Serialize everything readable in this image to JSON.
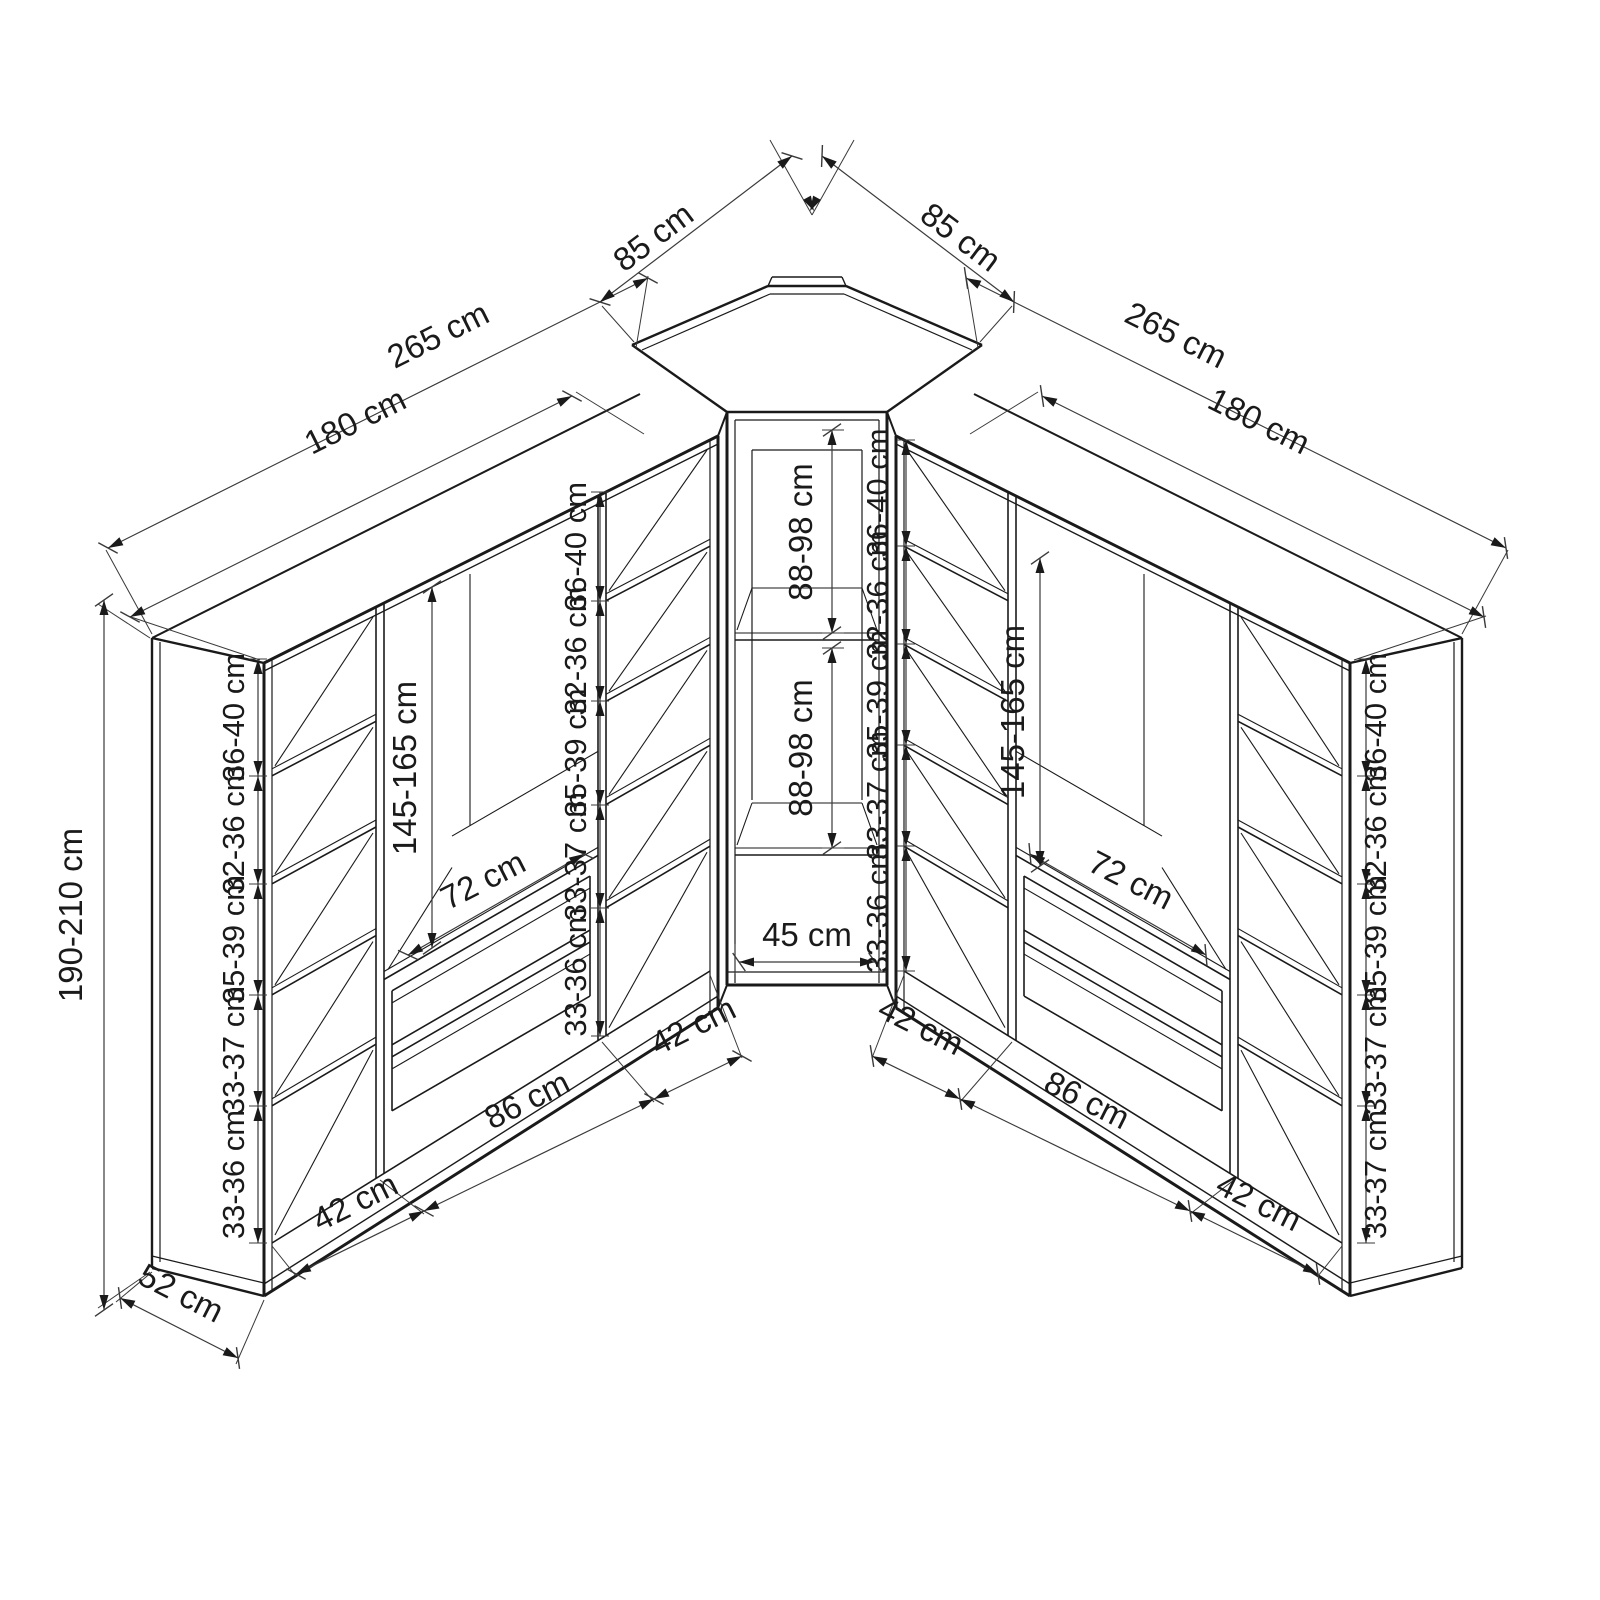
{
  "drawing": {
    "type": "corner-wardrobe-dimension-diagram",
    "unit": "cm"
  },
  "overall": {
    "height": "190-210 cm",
    "depth": "52 cm",
    "corner_front_left": "85 cm",
    "corner_front_right": "85 cm"
  },
  "left_wardrobe": {
    "total_width": "265 cm",
    "body_width": "180 cm",
    "outer_column": {
      "width": "42 cm",
      "shelf_spaces": [
        "36-40 cm",
        "32-36 cm",
        "35-39 cm",
        "33-37 cm",
        "33-36 cm"
      ]
    },
    "middle_section": {
      "hanging_height": "145-165 cm",
      "inner_width": "72 cm",
      "width": "86 cm"
    },
    "inner_column": {
      "width": "42 cm",
      "shelf_spaces": [
        "36-40 cm",
        "32-36 cm",
        "35-39 cm",
        "33-37 cm",
        "33-36 cm"
      ]
    }
  },
  "corner_unit": {
    "front_width": "45 cm",
    "upper_section_height": "88-98 cm",
    "lower_section_height": "88-98 cm"
  },
  "right_wardrobe": {
    "total_width": "265 cm",
    "body_width": "180 cm",
    "inner_column": {
      "width": "42 cm",
      "shelf_spaces": [
        "36-40 cm",
        "32-36 cm",
        "35-39 cm",
        "33-37 cm",
        "33-36 cm"
      ]
    },
    "middle_section": {
      "hanging_height": "145-165 cm",
      "inner_width": "72 cm",
      "width": "86 cm"
    },
    "outer_column": {
      "width": "42 cm",
      "shelf_spaces": [
        "36-40 cm",
        "32-36 cm",
        "35-39 cm",
        "33-37 cm",
        "33-37 cm"
      ]
    }
  }
}
